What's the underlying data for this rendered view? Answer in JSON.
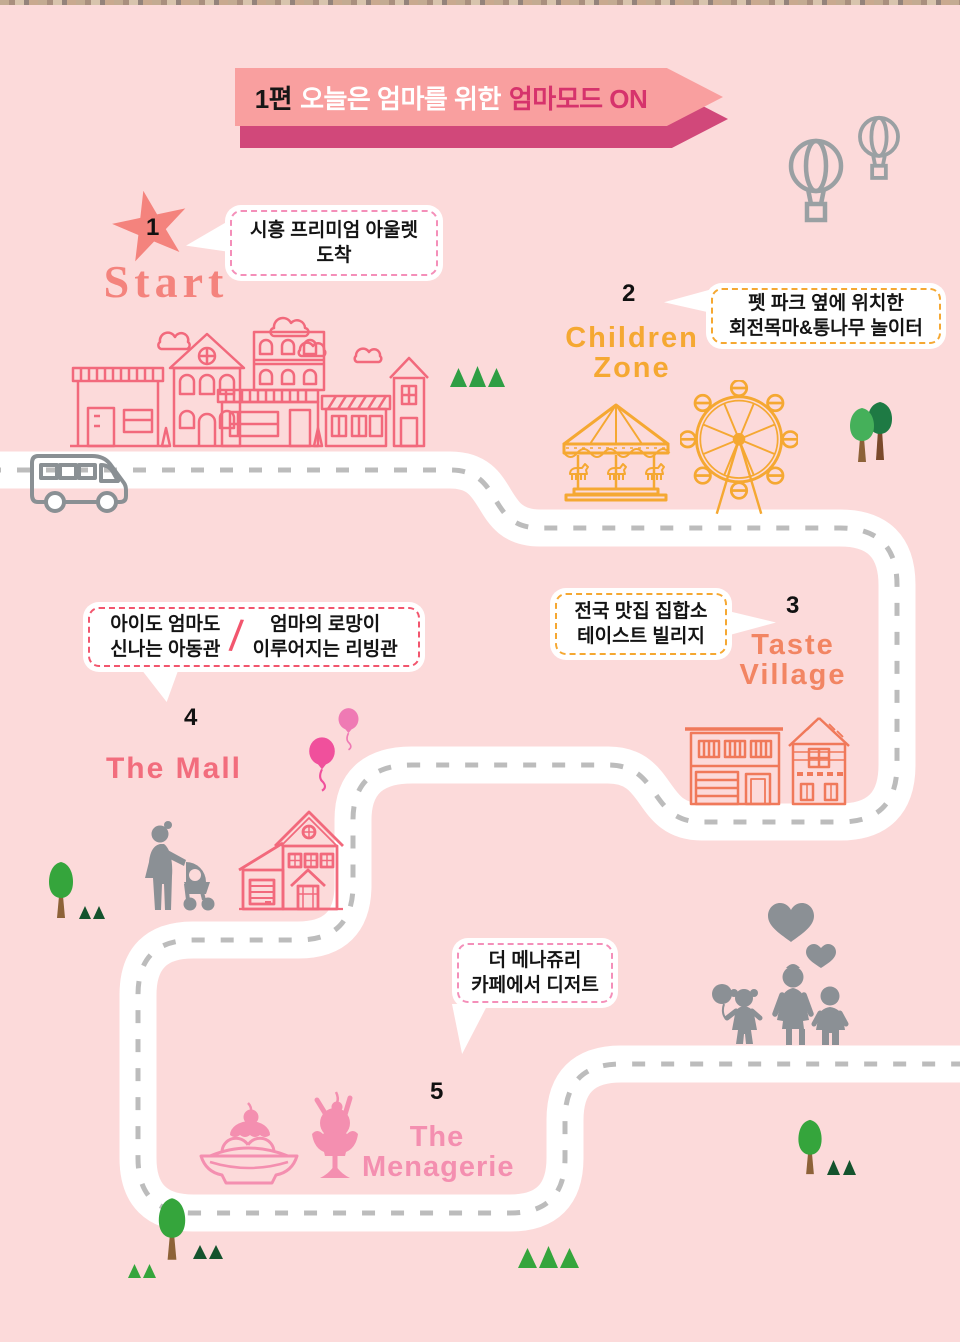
{
  "top_banner": {
    "episode": "1편",
    "title": "오늘은 엄마를 위한",
    "highlight": "엄마모드 ON"
  },
  "stops": {
    "start": {
      "num": "1",
      "label_lines": [
        "Start"
      ],
      "bubble_lines": [
        "시흥 프리미엄 아울렛",
        "도착"
      ]
    },
    "children_zone": {
      "num": "2",
      "label_lines": [
        "Children",
        "Zone"
      ],
      "bubble_lines": [
        "펫 파크 옆에 위치한",
        "회전목마&통나무 놀이터"
      ]
    },
    "taste_village": {
      "num": "3",
      "label_lines": [
        "Taste",
        "Village"
      ],
      "bubble_lines": [
        "전국 맛집 집합소",
        "테이스트 빌리지"
      ]
    },
    "the_mall": {
      "num": "4",
      "label_lines": [
        "The Mall"
      ],
      "bubble_left_lines": [
        "아이도 엄마도",
        "신나는 아동관"
      ],
      "bubble_divider": "/",
      "bubble_right_lines": [
        "엄마의 로망이",
        "이루어지는 리빙관"
      ]
    },
    "menagerie": {
      "num": "5",
      "label_lines": [
        "The",
        "Menagerie"
      ],
      "bubble_lines": [
        "더 메나쥬리",
        "카페에서 디저트"
      ]
    }
  },
  "icons": [
    "star-icon",
    "bus-icon",
    "hot-air-balloon-icon",
    "town-street-illustration",
    "carousel-icon",
    "ferris-wheel-icon",
    "round-tree-icon",
    "pine-tree-icon",
    "restaurant-buildings-illustration",
    "mall-house-icon",
    "mother-with-stroller-icon",
    "balloon-icon",
    "family-icon",
    "heart-icon",
    "banana-split-icon",
    "ice-cream-sundae-icon",
    "route-road"
  ],
  "colors": {
    "background": "#fcdada",
    "banner_fill": "#f99f9f",
    "banner_shadow": "#d1487a",
    "banner_highlight_text": "#d6336c",
    "start_accent": "#f4837d",
    "children_zone_accent": "#f5a832",
    "taste_village_accent": "#f28563",
    "mall_accent": "#f26d7d",
    "menagerie_accent": "#f48fb0",
    "road_dash": "#bcbcbc",
    "silhouette_gray": "#8b9095",
    "outline_gray": "#9aa0a3",
    "building_outline_pink": "#f2697c",
    "building_outline_coral": "#f0795a",
    "tree_green": "#35a53c",
    "tree_dark_green": "#14532d",
    "trunk_brown": "#8d6238",
    "balloon_pink": "#f0509c",
    "balloon_light_pink": "#ef7ab4",
    "bubble_border_pink": "#f48fb9",
    "bubble_border_orange": "#f5a832",
    "bubble_border_red": "#f2566e"
  }
}
